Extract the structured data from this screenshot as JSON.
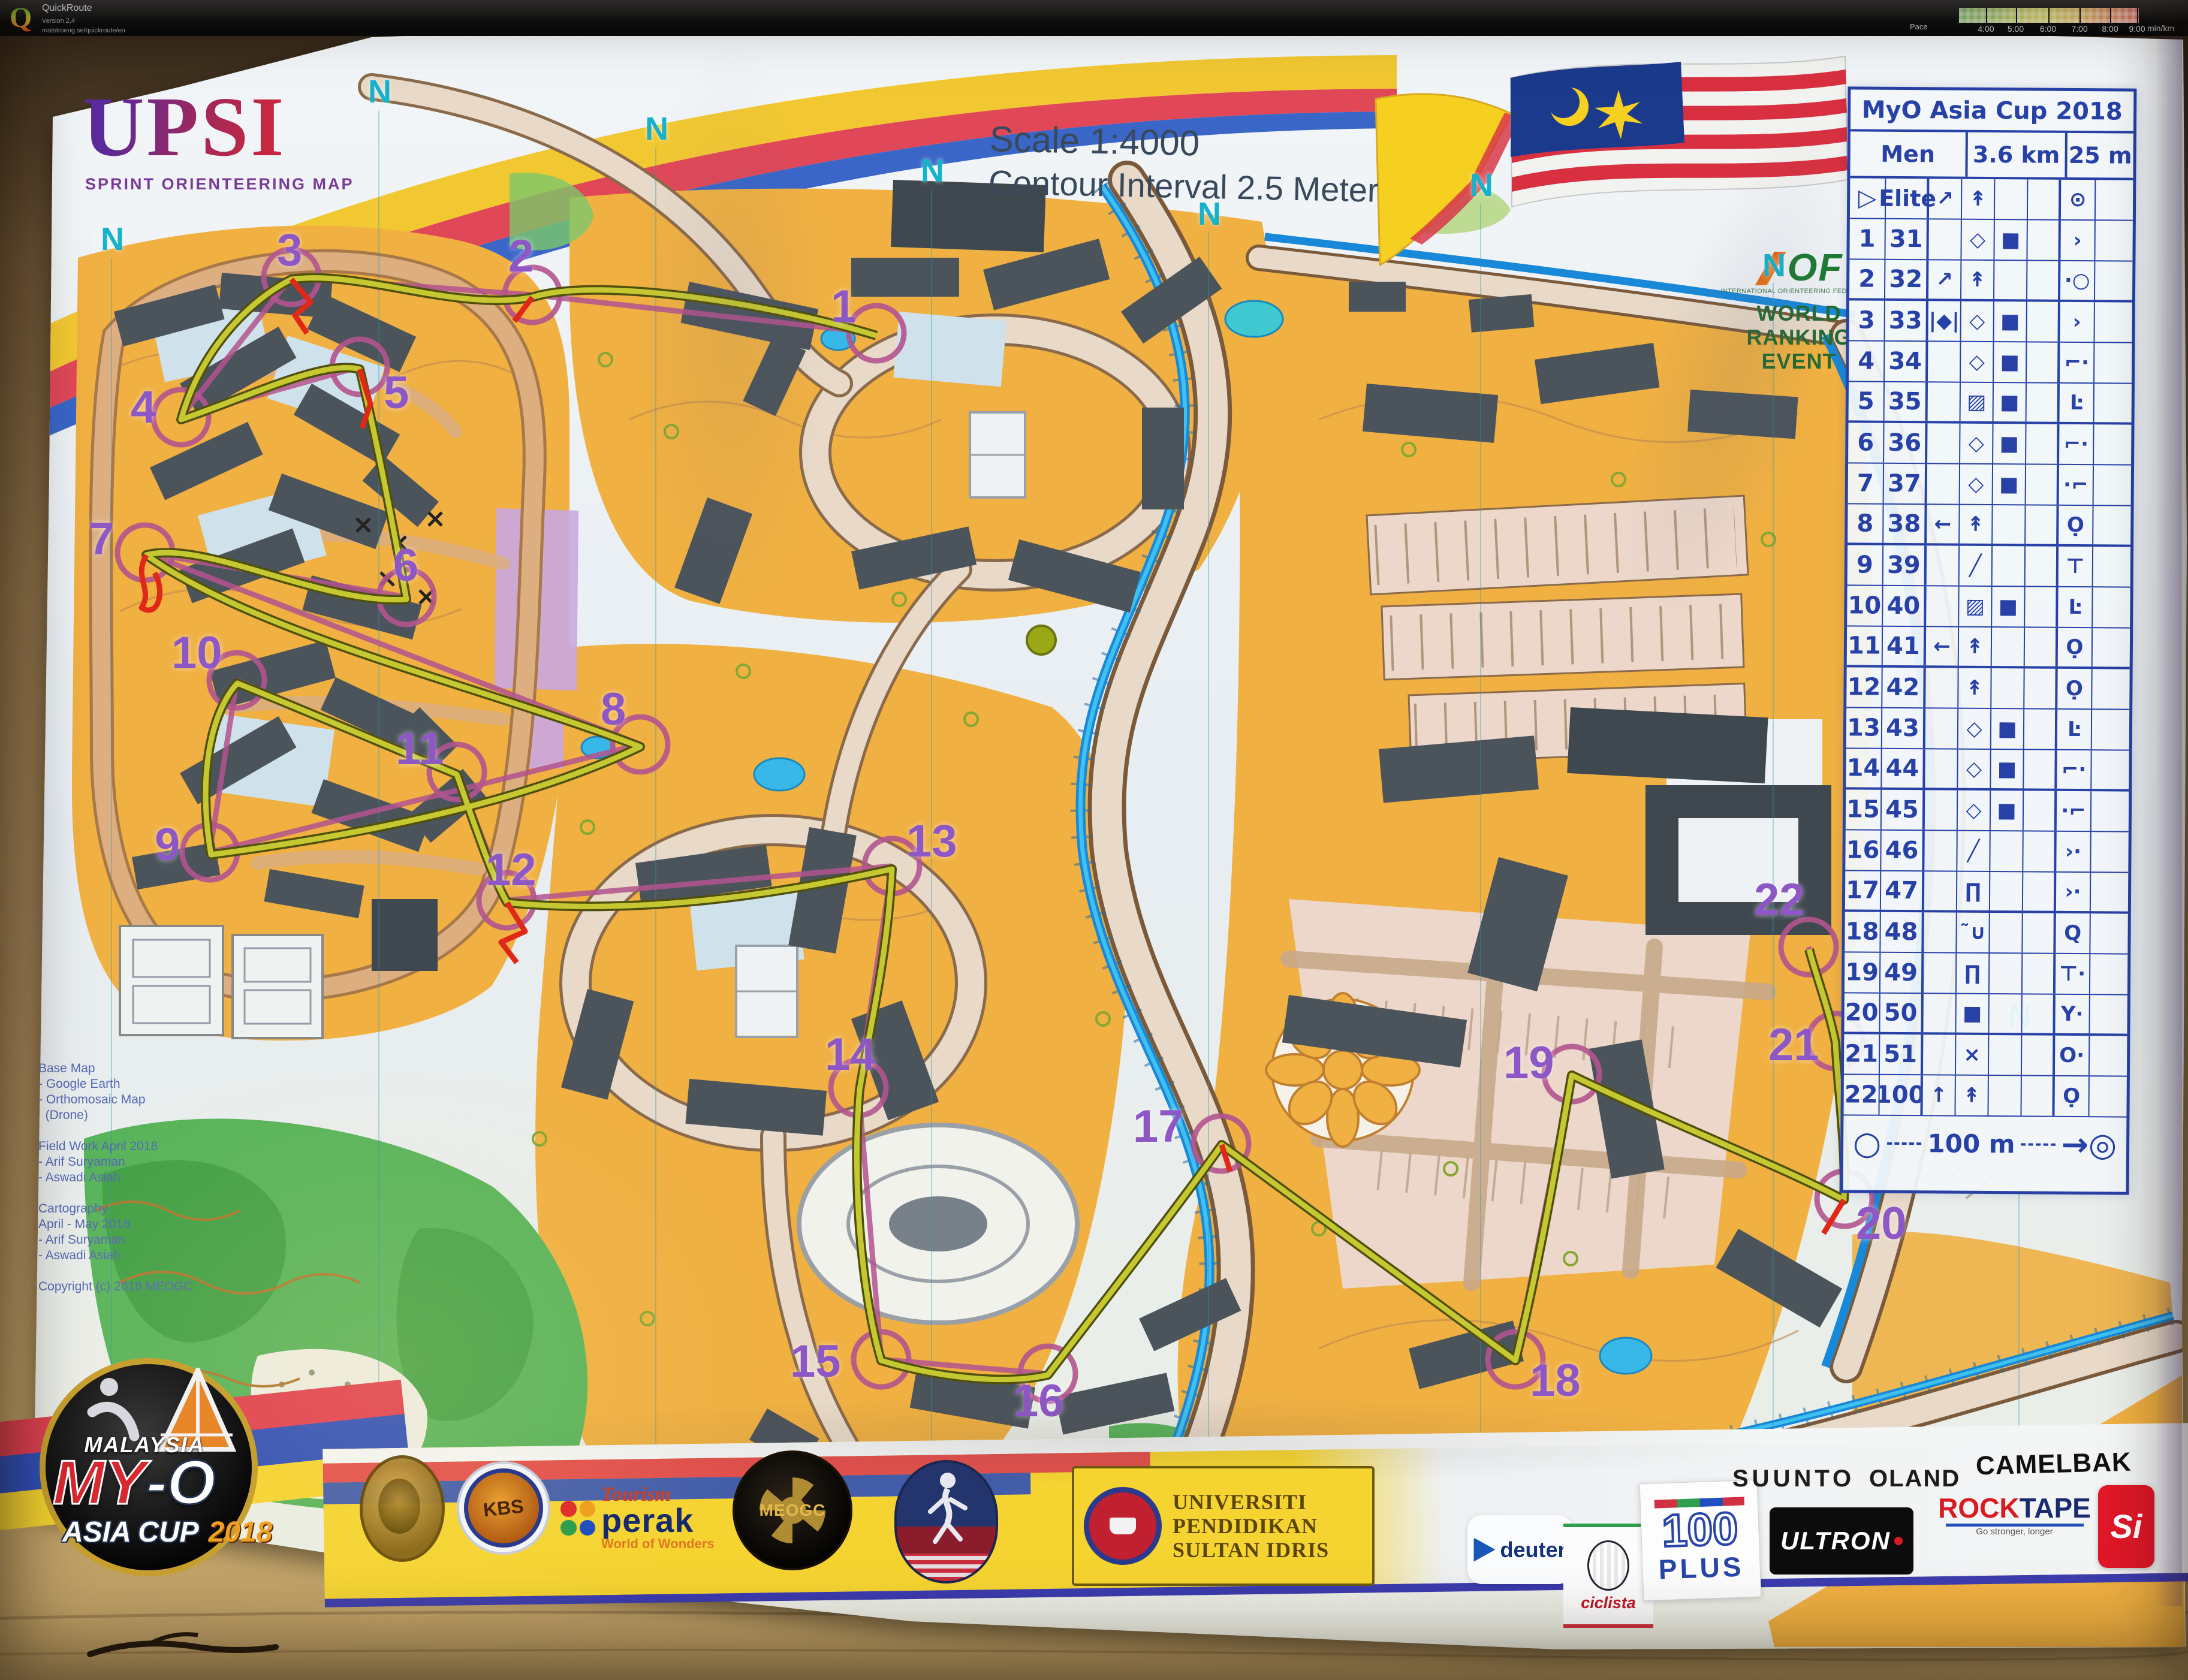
{
  "app": {
    "name": "QuickRoute",
    "version": "Version 2.4",
    "url": "matstroeng.se/quickroute/en",
    "logo_letter": "Q"
  },
  "legend": {
    "label": "Pace",
    "unit": "min/km",
    "ticks": [
      {
        "t": "4:00",
        "p": 15
      },
      {
        "t": "5:00",
        "p": 31.5
      },
      {
        "t": "6:00",
        "p": 49.5
      },
      {
        "t": "7:00",
        "p": 67
      },
      {
        "t": "8:00",
        "p": 84
      },
      {
        "t": "9:00",
        "p": 99
      }
    ]
  },
  "map": {
    "title": "UPSI",
    "subtitle": "SPRINT ORIENTEERING MAP",
    "scale": "Scale 1:4000",
    "contour": "Contour Interval  2.5 Meter",
    "iof": {
      "logo": "OF",
      "org": "INTERNATIONAL ORIENTEERING FEDERATION",
      "lines": [
        "WORLD",
        "RANKING",
        "EVENT"
      ]
    },
    "credits": [
      "Base Map",
      "- Google Earth",
      "- Orthomosaic Map",
      "  (Drone)",
      "",
      "Field Work April 2018",
      "- Arif Suryaman",
      "- Aswadi Asiah",
      "",
      "Cartography",
      "April - May 2018",
      "- Arif Suryaman",
      "- Aswadi Asiah",
      "",
      "Copyright (c) 2018 MEOGC"
    ],
    "north_letters": [
      {
        "label": "N",
        "x": 168,
        "y": 372
      },
      {
        "label": "N",
        "x": 614,
        "y": 126
      },
      {
        "label": "N",
        "x": 1076,
        "y": 188
      },
      {
        "label": "N",
        "x": 1536,
        "y": 258
      },
      {
        "label": "N",
        "x": 1998,
        "y": 330
      },
      {
        "label": "N",
        "x": 2452,
        "y": 282
      },
      {
        "label": "N",
        "x": 2940,
        "y": 416
      },
      {
        "label": "N",
        "x": 3350,
        "y": 1668
      }
    ],
    "controls": [
      {
        "label": "1",
        "x": 1386,
        "y": 474
      },
      {
        "label": "2",
        "x": 848,
        "y": 390
      },
      {
        "label": "3",
        "x": 462,
        "y": 380
      },
      {
        "label": "4",
        "x": 218,
        "y": 642
      },
      {
        "label": "5",
        "x": 640,
        "y": 618
      },
      {
        "label": "6",
        "x": 656,
        "y": 906
      },
      {
        "label": "7",
        "x": 148,
        "y": 862
      },
      {
        "label": "8",
        "x": 1002,
        "y": 1146
      },
      {
        "label": "9",
        "x": 258,
        "y": 1372
      },
      {
        "label": "10",
        "x": 286,
        "y": 1052
      },
      {
        "label": "11",
        "x": 660,
        "y": 1212
      },
      {
        "label": "12",
        "x": 810,
        "y": 1414
      },
      {
        "label": "13",
        "x": 1512,
        "y": 1366
      },
      {
        "label": "14",
        "x": 1376,
        "y": 1722
      },
      {
        "label": "15",
        "x": 1318,
        "y": 2234
      },
      {
        "label": "16",
        "x": 1690,
        "y": 2300
      },
      {
        "label": "17",
        "x": 1890,
        "y": 1842
      },
      {
        "label": "18",
        "x": 2552,
        "y": 2266
      },
      {
        "label": "19",
        "x": 2508,
        "y": 1736
      },
      {
        "label": "20",
        "x": 3096,
        "y": 2004
      },
      {
        "label": "21",
        "x": 2950,
        "y": 1706
      },
      {
        "label": "22",
        "x": 2926,
        "y": 1464
      }
    ]
  },
  "card": {
    "title": "MyO Asia Cup 2018",
    "header": [
      "Men Elite",
      "3.6 km",
      "25 m"
    ],
    "rows": [
      {
        "a": "▷",
        "b": "",
        "c": "↗",
        "d": "↟",
        "e": "",
        "f": "",
        "g": "⊙",
        "h": ""
      },
      {
        "a": "1",
        "b": "31",
        "c": "",
        "d": "◇",
        "e": "■",
        "f": "",
        "g": "›",
        "h": ""
      },
      {
        "a": "2",
        "b": "32",
        "c": "↗",
        "d": "↟",
        "e": "",
        "f": "",
        "g": "·○",
        "h": ""
      },
      {
        "a": "3",
        "b": "33",
        "c": "|◆|",
        "d": "◇",
        "e": "■",
        "f": "",
        "g": "›",
        "h": ""
      },
      {
        "a": "4",
        "b": "34",
        "c": "",
        "d": "◇",
        "e": "■",
        "f": "",
        "g": "⌐·",
        "h": ""
      },
      {
        "a": "5",
        "b": "35",
        "c": "",
        "d": "▨",
        "e": "■",
        "f": "",
        "g": "Ŀ",
        "h": ""
      },
      {
        "a": "6",
        "b": "36",
        "c": "",
        "d": "◇",
        "e": "■",
        "f": "",
        "g": "⌐·",
        "h": ""
      },
      {
        "a": "7",
        "b": "37",
        "c": "",
        "d": "◇",
        "e": "■",
        "f": "",
        "g": "·⌐",
        "h": ""
      },
      {
        "a": "8",
        "b": "38",
        "c": "←",
        "d": "↟",
        "e": "",
        "f": "",
        "g": "Ọ",
        "h": ""
      },
      {
        "a": "9",
        "b": "39",
        "c": "",
        "d": "╱",
        "e": "",
        "f": "",
        "g": "⊤",
        "h": ""
      },
      {
        "a": "10",
        "b": "40",
        "c": "",
        "d": "▨",
        "e": "■",
        "f": "",
        "g": "Ŀ",
        "h": ""
      },
      {
        "a": "11",
        "b": "41",
        "c": "←",
        "d": "↟",
        "e": "",
        "f": "",
        "g": "Ọ",
        "h": ""
      },
      {
        "a": "12",
        "b": "42",
        "c": "",
        "d": "↟",
        "e": "",
        "f": "",
        "g": "Ọ",
        "h": ""
      },
      {
        "a": "13",
        "b": "43",
        "c": "",
        "d": "◇",
        "e": "■",
        "f": "",
        "g": "Ŀ",
        "h": ""
      },
      {
        "a": "14",
        "b": "44",
        "c": "",
        "d": "◇",
        "e": "■",
        "f": "",
        "g": "⌐·",
        "h": ""
      },
      {
        "a": "15",
        "b": "45",
        "c": "",
        "d": "◇",
        "e": "■",
        "f": "",
        "g": "·⌐",
        "h": ""
      },
      {
        "a": "16",
        "b": "46",
        "c": "",
        "d": "╱",
        "e": "",
        "f": "",
        "g": "›·",
        "h": ""
      },
      {
        "a": "17",
        "b": "47",
        "c": "",
        "d": "∏",
        "e": "",
        "f": "",
        "g": "›·",
        "h": ""
      },
      {
        "a": "18",
        "b": "48",
        "c": "",
        "d": "˜∪",
        "e": "",
        "f": "",
        "g": "Q",
        "h": ""
      },
      {
        "a": "19",
        "b": "49",
        "c": "",
        "d": "∏",
        "e": "",
        "f": "",
        "g": "⊤·",
        "h": ""
      },
      {
        "a": "20",
        "b": "50",
        "c": "",
        "d": "■",
        "e": "",
        "f": "",
        "g": "Y·",
        "h": ""
      },
      {
        "a": "21",
        "b": "51",
        "c": "",
        "d": "×",
        "e": "",
        "f": "",
        "g": "O·",
        "h": ""
      },
      {
        "a": "22",
        "b": "100",
        "c": "↑",
        "d": "↟",
        "e": "",
        "f": "",
        "g": "Ọ",
        "h": ""
      }
    ],
    "scale_row": {
      "left": "○",
      "label": "100 m",
      "right": "→◎"
    }
  },
  "sponsors": {
    "kbs": "KBS",
    "tourism": "Tourism",
    "perak": "perak",
    "wow": "World of Wonders",
    "meogc": "MEOGC",
    "upsi_lines": [
      "UNIVERSITI",
      "PENDIDIKAN",
      "SULTAN IDRIS"
    ],
    "deuter": "deuter",
    "ciclista": "ciclista",
    "plus100_top": "100",
    "plus100_bottom": "PLUS",
    "suunto": "SUUNTO",
    "oland": "OLAND",
    "camelbak": "CAMELBAK",
    "ultron": "ULTRON",
    "rocktape_rock": "ROCK",
    "rocktape_tape": "TAPE",
    "rocktape_tag": "Go stronger, longer",
    "si": "Si"
  },
  "event_logo": {
    "country": "MALAYSIA",
    "name_red": "MY",
    "name_white": "-O",
    "series": "ASIA CUP",
    "year": "2018"
  }
}
